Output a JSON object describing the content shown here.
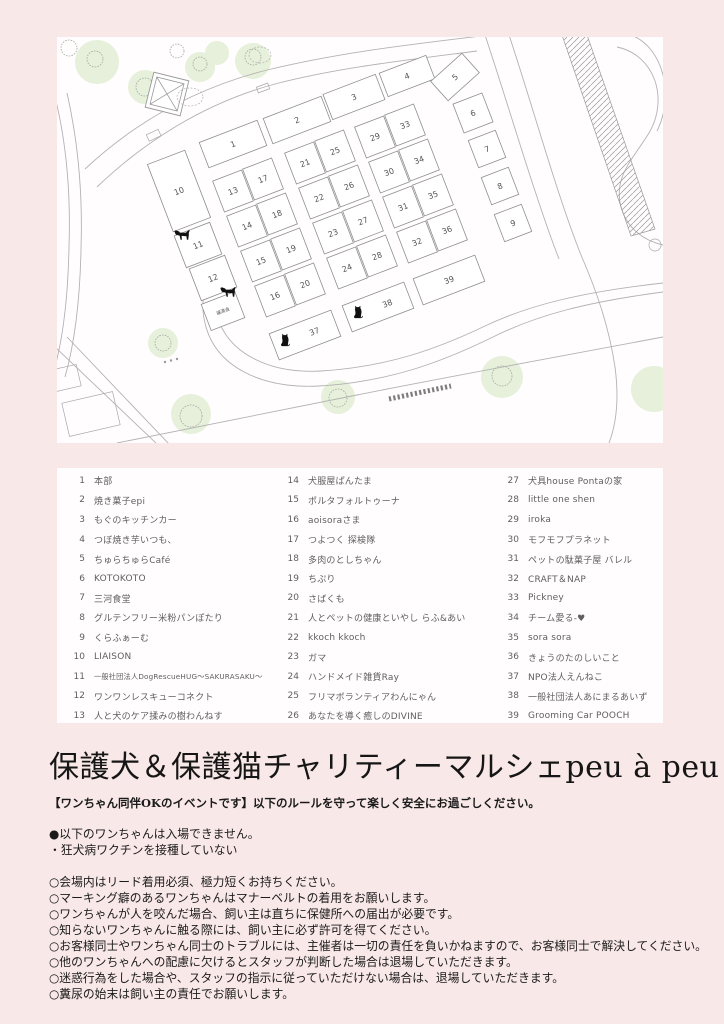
{
  "page": {
    "background": "#f9e8e8",
    "panel_background": "#fffdfd"
  },
  "title": "保護犬＆保護猫チャリティーマルシェpeu à peu",
  "subtitle": "【ワンちゃん同伴OKのイベントです】以下のルールを守って楽しく安全にお過ごしください。",
  "map": {
    "booth_rotation": -21,
    "line_color": "#b3b3b3",
    "booth_stroke": "#8f8f8f",
    "tree_color": "#e6f0da",
    "tree_outline_color": "#a3ab9f",
    "animal_color": "#111111",
    "adoption_label": "譲渡会",
    "booths": [
      {
        "n": "1",
        "x": 176,
        "y": 107,
        "w": 62,
        "h": 27
      },
      {
        "n": "2",
        "x": 240,
        "y": 83,
        "w": 62,
        "h": 27
      },
      {
        "n": "3",
        "x": 297,
        "y": 60,
        "w": 56,
        "h": 27
      },
      {
        "n": "4",
        "x": 350,
        "y": 39,
        "w": 50,
        "h": 25
      },
      {
        "n": "5",
        "x": 398,
        "y": 40,
        "w": 42,
        "h": 26,
        "r": -42
      },
      {
        "n": "6",
        "x": 416,
        "y": 76,
        "w": 31,
        "h": 31
      },
      {
        "n": "7",
        "x": 430,
        "y": 112,
        "w": 29,
        "h": 29
      },
      {
        "n": "8",
        "x": 443,
        "y": 149,
        "w": 29,
        "h": 29
      },
      {
        "n": "9",
        "x": 456,
        "y": 186,
        "w": 29,
        "h": 29
      },
      {
        "n": "10",
        "x": 122,
        "y": 154,
        "w": 40,
        "h": 72
      },
      {
        "n": "11",
        "x": 141,
        "y": 208,
        "w": 38,
        "h": 34
      },
      {
        "n": "12",
        "x": 156,
        "y": 241,
        "w": 38,
        "h": 34
      },
      {
        "n": "譲渡会",
        "x": 166,
        "y": 274,
        "w": 36,
        "h": 28,
        "label": true
      },
      {
        "n": "13",
        "x": 176,
        "y": 154,
        "w": 31,
        "h": 33
      },
      {
        "n": "17",
        "x": 206,
        "y": 142,
        "w": 31,
        "h": 33
      },
      {
        "n": "14",
        "x": 190,
        "y": 189,
        "w": 31,
        "h": 33
      },
      {
        "n": "18",
        "x": 220,
        "y": 177,
        "w": 31,
        "h": 33
      },
      {
        "n": "15",
        "x": 204,
        "y": 224,
        "w": 31,
        "h": 33
      },
      {
        "n": "19",
        "x": 234,
        "y": 212,
        "w": 31,
        "h": 33
      },
      {
        "n": "16",
        "x": 218,
        "y": 259,
        "w": 31,
        "h": 33
      },
      {
        "n": "20",
        "x": 248,
        "y": 247,
        "w": 31,
        "h": 33
      },
      {
        "n": "21",
        "x": 248,
        "y": 126,
        "w": 31,
        "h": 33
      },
      {
        "n": "25",
        "x": 278,
        "y": 114,
        "w": 31,
        "h": 33
      },
      {
        "n": "22",
        "x": 262,
        "y": 161,
        "w": 31,
        "h": 33
      },
      {
        "n": "26",
        "x": 292,
        "y": 149,
        "w": 31,
        "h": 33
      },
      {
        "n": "23",
        "x": 276,
        "y": 196,
        "w": 31,
        "h": 33
      },
      {
        "n": "27",
        "x": 306,
        "y": 184,
        "w": 31,
        "h": 33
      },
      {
        "n": "24",
        "x": 290,
        "y": 231,
        "w": 31,
        "h": 33
      },
      {
        "n": "28",
        "x": 320,
        "y": 219,
        "w": 31,
        "h": 33
      },
      {
        "n": "29",
        "x": 318,
        "y": 100,
        "w": 31,
        "h": 33
      },
      {
        "n": "33",
        "x": 348,
        "y": 88,
        "w": 31,
        "h": 33
      },
      {
        "n": "30",
        "x": 332,
        "y": 135,
        "w": 31,
        "h": 33
      },
      {
        "n": "34",
        "x": 362,
        "y": 123,
        "w": 31,
        "h": 33
      },
      {
        "n": "31",
        "x": 346,
        "y": 170,
        "w": 31,
        "h": 33
      },
      {
        "n": "35",
        "x": 376,
        "y": 158,
        "w": 31,
        "h": 33
      },
      {
        "n": "32",
        "x": 360,
        "y": 205,
        "w": 31,
        "h": 33
      },
      {
        "n": "36",
        "x": 390,
        "y": 193,
        "w": 31,
        "h": 33
      },
      {
        "n": "37",
        "x": 248,
        "y": 298,
        "w": 66,
        "h": 28,
        "nx": 10
      },
      {
        "n": "38",
        "x": 321,
        "y": 270,
        "w": 66,
        "h": 28,
        "nx": 10
      },
      {
        "n": "39",
        "x": 392,
        "y": 243,
        "w": 66,
        "h": 28
      }
    ],
    "trees": [
      {
        "x": 40,
        "y": 25,
        "r": 22
      },
      {
        "x": 88,
        "y": 50,
        "r": 17
      },
      {
        "x": 143,
        "y": 30,
        "r": 15
      },
      {
        "x": 196,
        "y": 24,
        "r": 18
      },
      {
        "x": 160,
        "y": 16,
        "r": 12
      },
      {
        "x": 106,
        "y": 306,
        "r": 15
      },
      {
        "x": 134,
        "y": 377,
        "r": 20
      },
      {
        "x": 281,
        "y": 360,
        "r": 17
      },
      {
        "x": 445,
        "y": 340,
        "r": 21
      },
      {
        "x": 597,
        "y": 352,
        "r": 23
      }
    ],
    "tree_outlines": [
      {
        "x": 12,
        "y": 11,
        "r": 8
      },
      {
        "x": 38,
        "y": 22,
        "r": 8
      },
      {
        "x": 88,
        "y": 50,
        "r": 9
      },
      {
        "x": 143,
        "y": 27,
        "r": 7
      },
      {
        "x": 196,
        "y": 20,
        "r": 8
      },
      {
        "x": 120,
        "y": 14,
        "r": 7
      },
      {
        "x": 106,
        "y": 306,
        "r": 8
      },
      {
        "x": 134,
        "y": 379,
        "r": 11
      },
      {
        "x": 281,
        "y": 361,
        "r": 9
      },
      {
        "x": 445,
        "y": 339,
        "r": 10
      }
    ],
    "animals": [
      {
        "type": "dog",
        "x": 125,
        "y": 198
      },
      {
        "type": "dog",
        "x": 171,
        "y": 255
      },
      {
        "type": "cat",
        "x": 228,
        "y": 303
      },
      {
        "type": "cat",
        "x": 301,
        "y": 275
      }
    ]
  },
  "legend": {
    "columns": [
      [
        {
          "n": "1",
          "name": "本部"
        },
        {
          "n": "2",
          "name": "焼き菓子epi"
        },
        {
          "n": "3",
          "name": "もぐのキッチンカー"
        },
        {
          "n": "4",
          "name": "つぼ焼き芋いつも、"
        },
        {
          "n": "5",
          "name": "ちゅらちゅらCafé"
        },
        {
          "n": "6",
          "name": "KOTOKOTO"
        },
        {
          "n": "7",
          "name": "三河食堂"
        },
        {
          "n": "8",
          "name": "グルテンフリー米粉パンぽたり"
        },
        {
          "n": "9",
          "name": "くらふぁーむ"
        },
        {
          "n": "10",
          "name": "LIAISON"
        },
        {
          "n": "11",
          "name": "一般社団法人DogRescueHUG〜SAKURASAKU〜"
        },
        {
          "n": "12",
          "name": "ワンワンレスキューコネクト"
        },
        {
          "n": "13",
          "name": "人と犬のケア揉みの樹わんねす"
        }
      ],
      [
        {
          "n": "14",
          "name": "犬服屋ぱんたま"
        },
        {
          "n": "15",
          "name": "ポルタフォルトゥーナ"
        },
        {
          "n": "16",
          "name": "aoisoraさま"
        },
        {
          "n": "17",
          "name": "つよつく 探検隊"
        },
        {
          "n": "18",
          "name": "多肉のとしちゃん"
        },
        {
          "n": "19",
          "name": "ちぷり"
        },
        {
          "n": "20",
          "name": "さばくも"
        },
        {
          "n": "21",
          "name": "人とペットの健康といやし らふ&あい"
        },
        {
          "n": "22",
          "name": "kkoch kkoch"
        },
        {
          "n": "23",
          "name": "ガマ"
        },
        {
          "n": "24",
          "name": "ハンドメイド雑貨Ray"
        },
        {
          "n": "25",
          "name": "フリマボランティアわんにゃん"
        },
        {
          "n": "26",
          "name": "あなたを導く癒しのDIVINE"
        }
      ],
      [
        {
          "n": "27",
          "name": "犬具house Pontaの家"
        },
        {
          "n": "28",
          "name": "little one shen"
        },
        {
          "n": "29",
          "name": "iroka"
        },
        {
          "n": "30",
          "name": "モフモフプラネット"
        },
        {
          "n": "31",
          "name": "ペットの駄菓子屋 バレル"
        },
        {
          "n": "32",
          "name": "CRAFT＆NAP"
        },
        {
          "n": "33",
          "name": "Pickney"
        },
        {
          "n": "34",
          "name": "チーム愛る-♥"
        },
        {
          "n": "35",
          "name": "sora sora"
        },
        {
          "n": "36",
          "name": "きょうのたのしいこと"
        },
        {
          "n": "37",
          "name": "NPO法人えんねこ"
        },
        {
          "n": "38",
          "name": "一般社団法人あにまるあいず"
        },
        {
          "n": "39",
          "name": "Grooming Car POOCH"
        }
      ]
    ]
  },
  "rules": {
    "no_entry_header": "●以下のワンちゃんは入場できません。",
    "no_entry_items": [
      "・狂犬病ワクチンを接種していない"
    ],
    "rules_list": [
      "○会場内はリード着用必須、極力短くお持ちください。",
      "○マーキング癖のあるワンちゃんはマナーベルトの着用をお願いします。",
      "○ワンちゃんが人を咬んだ場合、飼い主は直ちに保健所への届出が必要です。",
      "○知らないワンちゃんに触る際には、飼い主に必ず許可を得てください。",
      "○お客様同士やワンちゃん同士のトラブルには、主催者は一切の責任を負いかねますので、お客様同士で解決してください。",
      "○他のワンちゃんへの配慮に欠けるとスタッフが判断した場合は退場していただきます。",
      "○迷惑行為をした場合や、スタッフの指示に従っていただけない場合は、退場していただきます。",
      "○糞尿の始末は飼い主の責任でお願いします。"
    ]
  }
}
